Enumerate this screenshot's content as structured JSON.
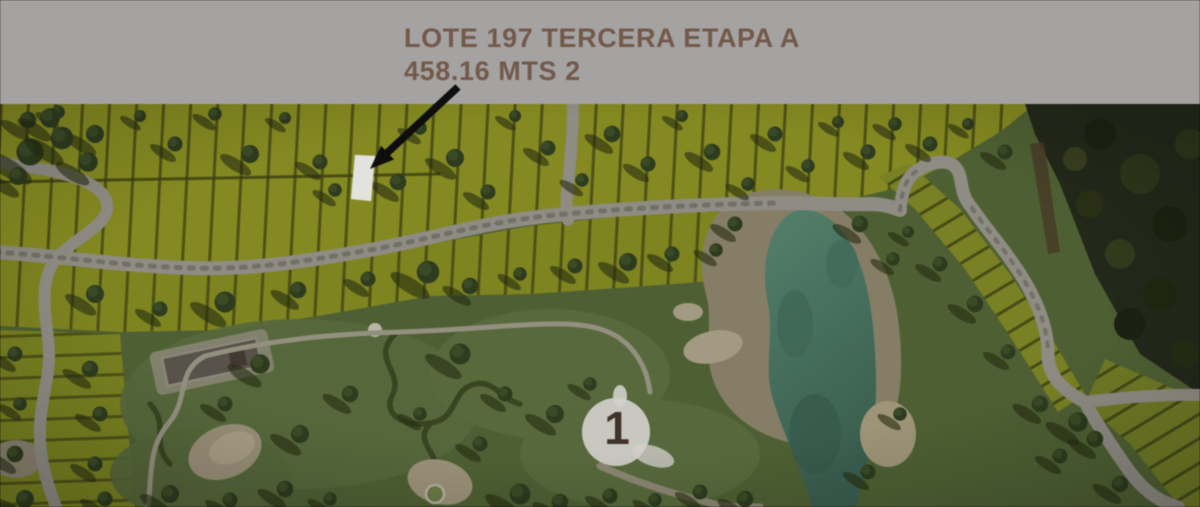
{
  "banner": {
    "title": "LOTE 197 TERCERA ETAPA A",
    "subtitle": "458.16 MTS 2",
    "text_color": "#73594a",
    "background_color": "#a5a3a2"
  },
  "map": {
    "description": "aerial master-plan rendering of a residential golf community",
    "highlighted_lot": {
      "lot": "LOTE 197",
      "stage": "TERCERA ETAPA A",
      "area": "458.16 MTS 2"
    },
    "hole_marker": {
      "label": "1"
    },
    "colors": {
      "lot_olive": "#848921",
      "road_gray": "#8e8c83",
      "golf_green": "#4e6033",
      "lake_teal": "#4a7763",
      "forest_dark": "#23281a",
      "sand_beige": "#978e76",
      "arrow_black": "#0e0e0e",
      "highlight_white": "#e3e3de"
    }
  }
}
